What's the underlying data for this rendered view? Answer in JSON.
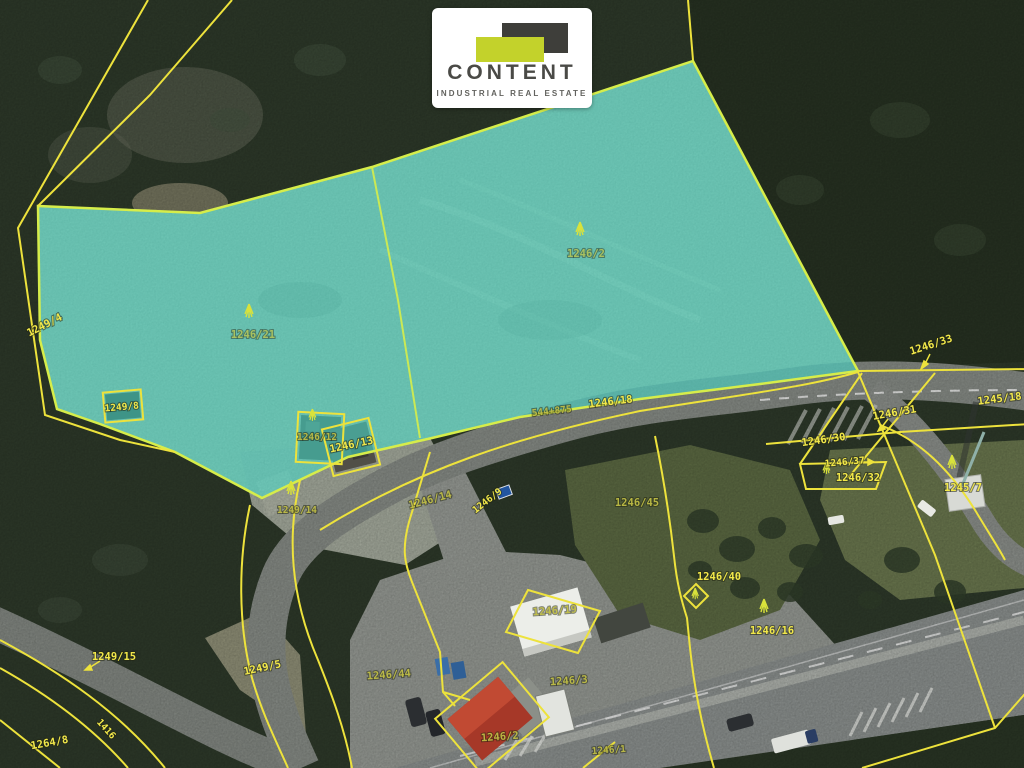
{
  "brand": {
    "name": "CONTENT",
    "tagline": "INDUSTRIAL REAL ESTATE"
  },
  "map": {
    "type": "cadastral-aerial",
    "highlight_fill": "#45E0CF",
    "parcel_line_color": "#EDE23C",
    "label_color_bright": "#F2E84A",
    "label_color_olive": "#BDBB44",
    "labels": [
      {
        "text": "1249/4"
      },
      {
        "text": "1246/21"
      },
      {
        "text": "1246/2"
      },
      {
        "text": "1249/8"
      },
      {
        "text": "1246/12"
      },
      {
        "text": "1246/13"
      },
      {
        "text": "544+875"
      },
      {
        "text": "1246/18"
      },
      {
        "text": "1246/14"
      },
      {
        "text": "1246/9"
      },
      {
        "text": "1249/14"
      },
      {
        "text": "1246/31"
      },
      {
        "text": "1246/30"
      },
      {
        "text": "1246/37"
      },
      {
        "text": "1246/32"
      },
      {
        "text": "1246/33"
      },
      {
        "text": "1245/18"
      },
      {
        "text": "1245/7"
      },
      {
        "text": "1246/45"
      },
      {
        "text": "1246/40"
      },
      {
        "text": "1246/16"
      },
      {
        "text": "1246/19"
      },
      {
        "text": "1246/44"
      },
      {
        "text": "1246/3"
      },
      {
        "text": "1246/2"
      },
      {
        "text": "1246/1"
      },
      {
        "text": "1249/15"
      },
      {
        "text": "1249/5"
      },
      {
        "text": "1264/8"
      },
      {
        "text": "1416"
      }
    ]
  }
}
